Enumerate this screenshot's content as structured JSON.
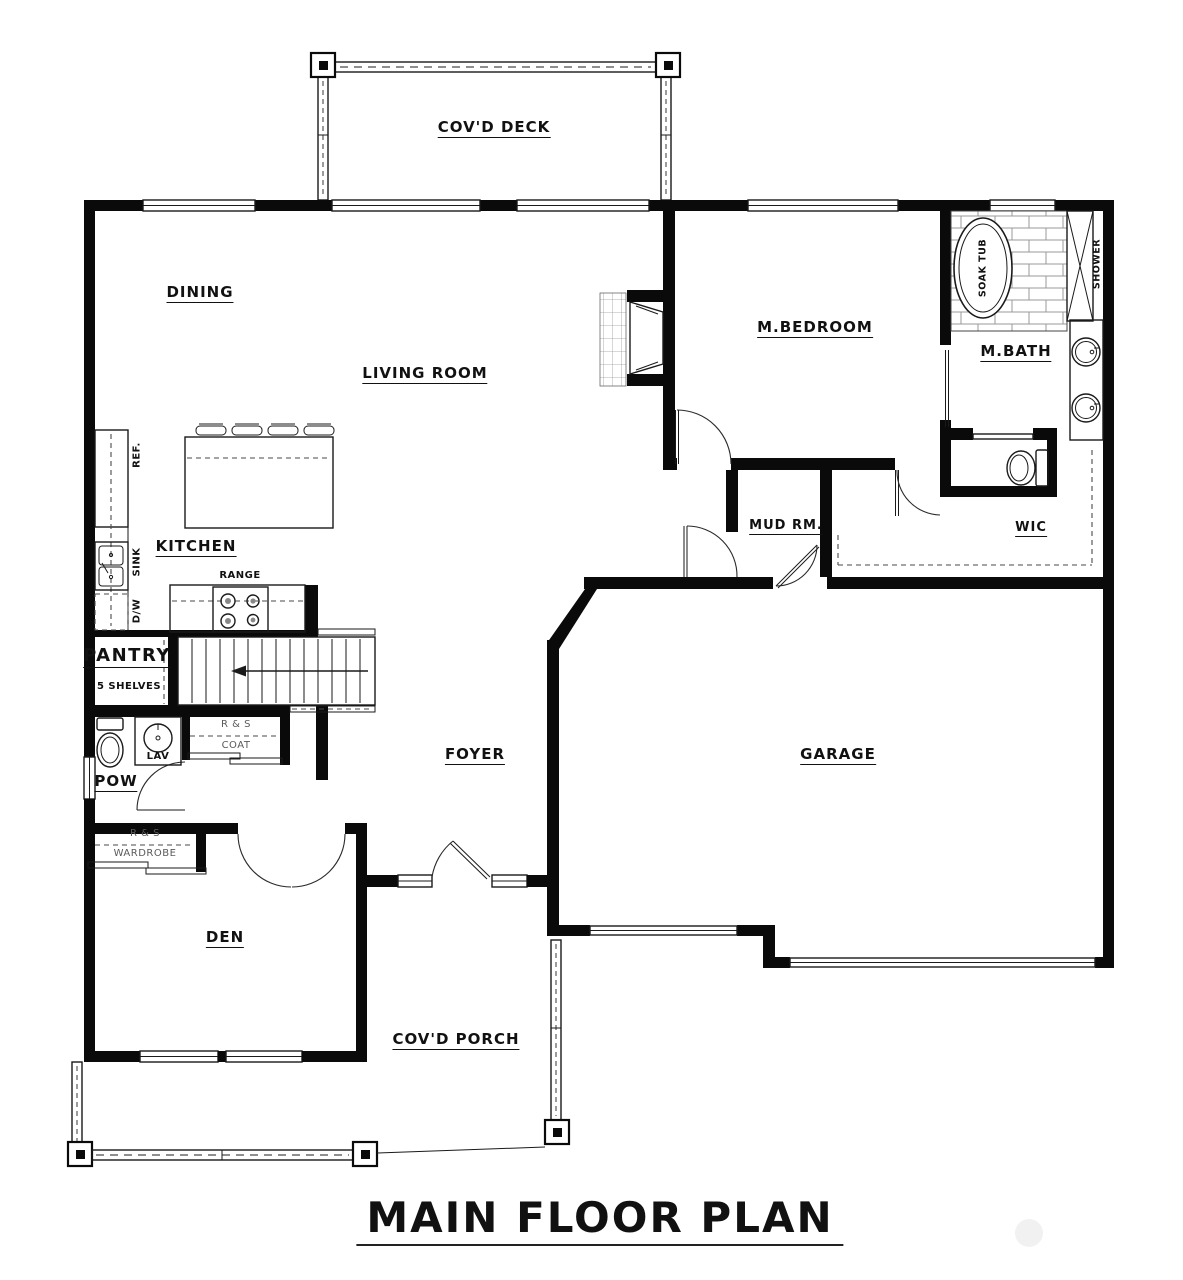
{
  "title": "MAIN FLOOR PLAN",
  "rooms": {
    "covd_deck": "COV'D DECK",
    "dining": "DINING",
    "living_room": "LIVING ROOM",
    "m_bedroom": "M.BEDROOM",
    "m_bath": "M.BATH",
    "kitchen": "KITCHEN",
    "pantry": "PANTRY",
    "mud_rm": "MUD RM.",
    "wic": "WIC",
    "foyer": "FOYER",
    "garage": "GARAGE",
    "pow": "POW",
    "den": "DEN",
    "covd_porch": "COV'D PORCH"
  },
  "fixtures": {
    "ref": "REF.",
    "sink": "SINK",
    "dw": "D/W",
    "range": "RANGE",
    "soak_tub": "SOAK TUB",
    "shower": "SHOWER",
    "lav": "LAV"
  },
  "closets": {
    "pantry_shelves": "5 SHELVES",
    "coat_rs": "R & S",
    "coat": "COAT",
    "wardrobe_rs": "R & S",
    "wardrobe": "WARDROBE"
  },
  "colors": {
    "wall": "#0a0a0a",
    "line": "#1a1a1a",
    "dash": "#4a4a4a",
    "brick": "#999999",
    "watermark": "#f1f1f1",
    "background": "#ffffff"
  }
}
